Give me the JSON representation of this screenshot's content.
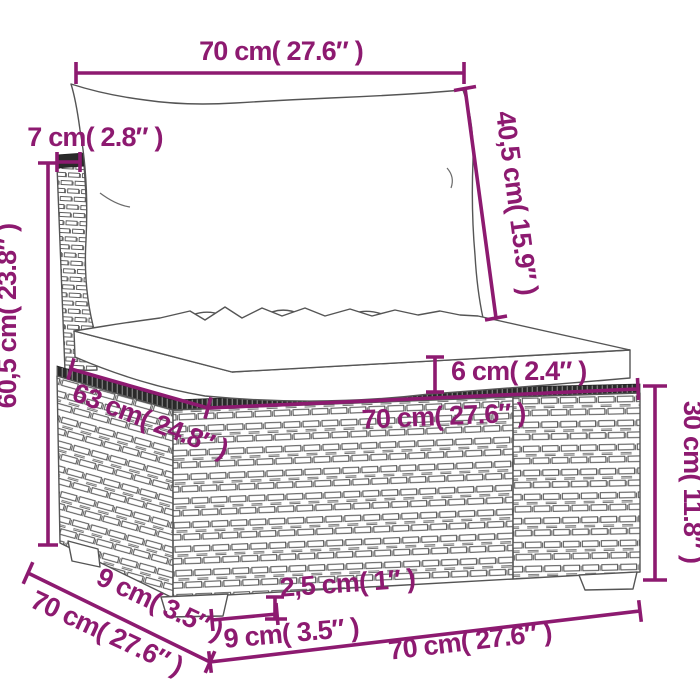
{
  "diagram": {
    "subject": "wicker-sofa-section-with-cushions",
    "labels": {
      "top_width": "70 cm( 27.6″ )",
      "back_thickness": "7 cm( 2.8″ )",
      "total_height": "60,5 cm( 23.8″ )",
      "back_cushion_height": "40,5 cm( 15.9″ )",
      "seat_cushion_thickness": "6 cm( 2.4″ )",
      "seat_depth": "63 cm( 24.8″ )",
      "seat_width": "70 cm( 27.6″ )",
      "base_height": "30 cm( 11.8″ )",
      "foot_side_depth": "9 cm( 3.5″ )",
      "side_depth": "70 cm( 27.6″ )",
      "foot_width": "9 cm( 3.5″ )",
      "foot_height": "2,5 cm( 1″ )",
      "bottom_width": "70 cm( 27.6″ )"
    },
    "colors": {
      "dimension_accent": "#8d1a70",
      "line_art": "#555555",
      "dark_band": "#2a2a2a"
    }
  }
}
